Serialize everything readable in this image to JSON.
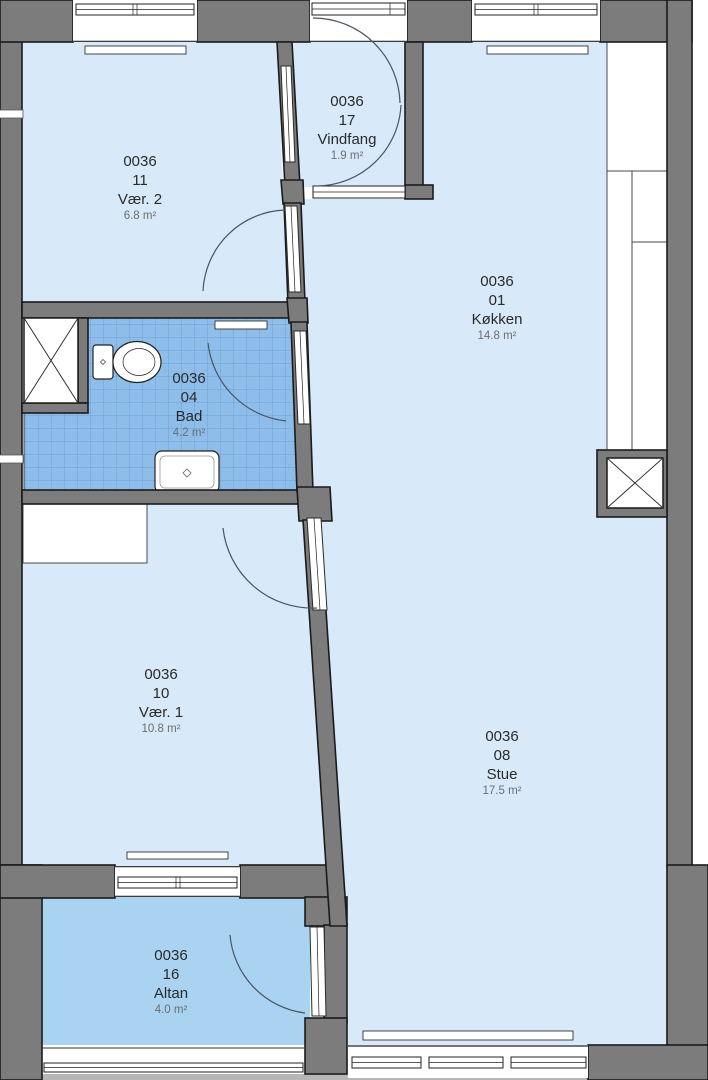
{
  "rooms": [
    {
      "number": "0036",
      "id": "11",
      "name": "Vær. 2",
      "area": "6.8 m²"
    },
    {
      "number": "0036",
      "id": "17",
      "name": "Vindfang",
      "area": "1.9 m²"
    },
    {
      "number": "0036",
      "id": "01",
      "name": "Køkken",
      "area": "14.8 m²"
    },
    {
      "number": "0036",
      "id": "04",
      "name": "Bad",
      "area": "4.2 m²"
    },
    {
      "number": "0036",
      "id": "10",
      "name": "Vær. 1",
      "area": "10.8 m²"
    },
    {
      "number": "0036",
      "id": "08",
      "name": "Stue",
      "area": "17.5 m²"
    },
    {
      "number": "0036",
      "id": "16",
      "name": "Altan",
      "area": "4.0 m²"
    }
  ],
  "colors": {
    "wall": "#7c7c7c",
    "wall_outline": "#1b1b1b",
    "floor": "#d8e9fa",
    "tile": "#8fbde9",
    "tile_grid": "#6aa3d8",
    "balcony": "#a9d3f1",
    "arc": "#4a5560",
    "label": "#2a2a2a",
    "label_area": "#6e6e6e",
    "outside_strip": "#b6b6b6"
  }
}
